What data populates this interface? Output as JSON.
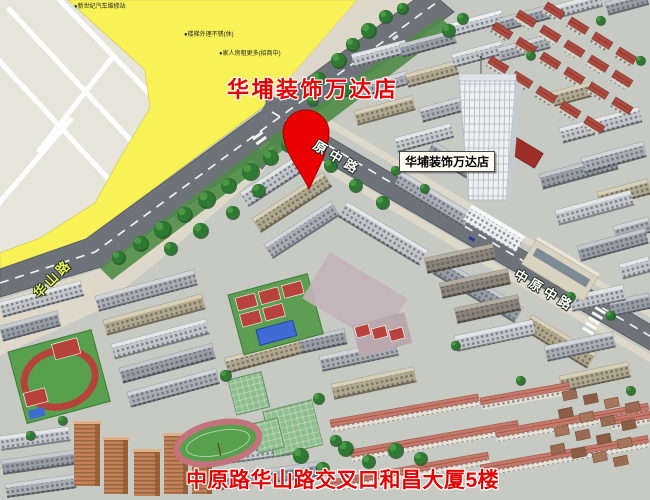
{
  "map": {
    "title_overlay": "华埔装饰万达店",
    "poi_label": "华埔装饰万达店",
    "address_overlay": "中原路华山路交叉口和昌大厦5楼",
    "roads": {
      "huashan": "华山路",
      "zhongyuan_mid_partial": "原中路",
      "zhongyuan_mid": "中原中路"
    },
    "small_pois": [
      "新世纪汽车维修站",
      "楼梯外理不锈(休)",
      "家人房租更多(招商中)"
    ],
    "palette": {
      "accent_red": "#e60000",
      "pin_red": "#e90000",
      "pin_edge": "#a50000",
      "road": "#6d7379",
      "road_edge": "#575d63",
      "road_line": "#ffffff",
      "yellow_zone": "#f8f257",
      "vacant": "#e7e4d9",
      "sidewalk": "#ddd8ca",
      "plaza_pink": "#e8d9cb",
      "ground": "#c6cac3",
      "lawn": "#4f8c47",
      "tree": "#2f7a33",
      "tree_dark": "#245c28",
      "track_red": "#b5433a",
      "track_pink": "#c4737c",
      "field_green": "#58a04e",
      "court_red": "#b8433c",
      "court_blue": "#3f6bd4",
      "glass_green": "#8fbe8f",
      "tower_white": "#eef0f2",
      "salmon_roof": "#c5796b",
      "red_roof": "#ad4a40",
      "rust": "#9a6b52",
      "brick_orange": "#c28157",
      "label_yellow": "#e9ef5c"
    }
  }
}
